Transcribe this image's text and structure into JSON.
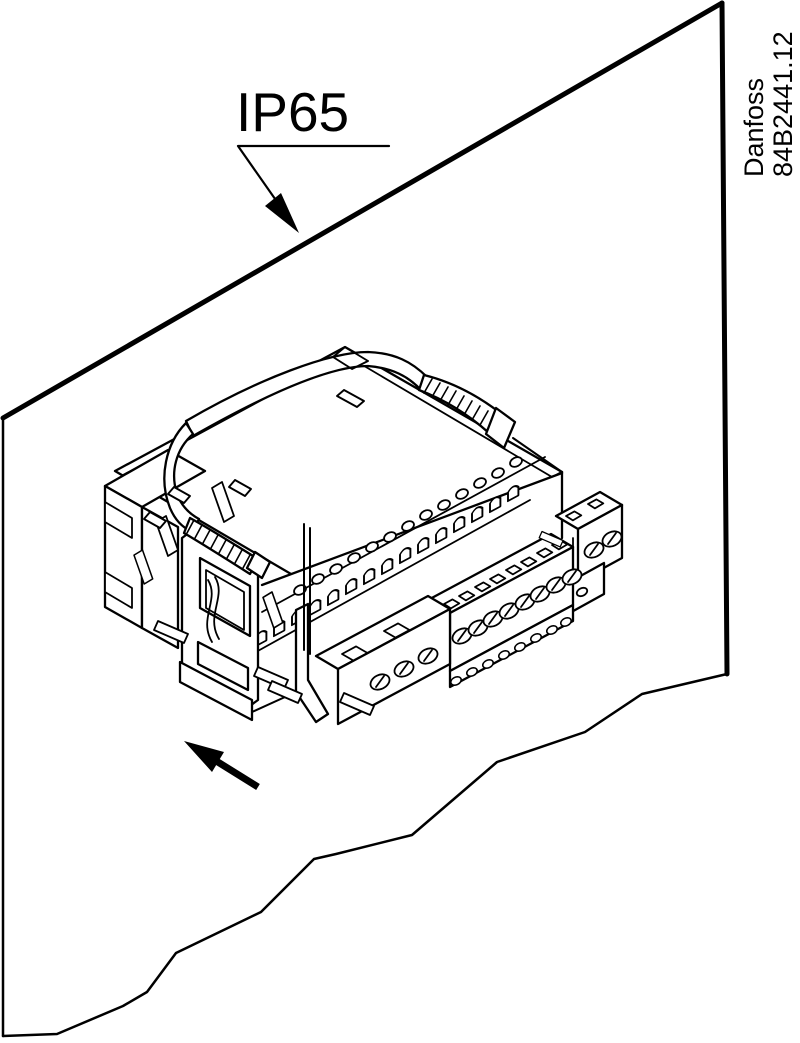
{
  "canvas": {
    "width": 800,
    "height": 1043,
    "background": "#ffffff",
    "line_color": "#000000"
  },
  "annotations": {
    "protection_label": "IP65",
    "brand": "Danfoss",
    "drawing_number": "84B2441.12"
  },
  "figure": {
    "type": "technical-line-drawing",
    "subject": "Controller module with spring mounting bow and screw terminal blocks shown being fitted through a cut-out in a panel",
    "panel": {
      "style": "sheet with torn-off lower edge",
      "label_pointed_at_edge": "IP65"
    },
    "icons": [
      "ip65-leader-arrow",
      "insertion-direction-arrow"
    ],
    "counts": {
      "vent_holes": 13,
      "wire_arches": 15,
      "screws_main_block": 8,
      "screws_left_block": 3,
      "screws_right_block": 2
    }
  }
}
